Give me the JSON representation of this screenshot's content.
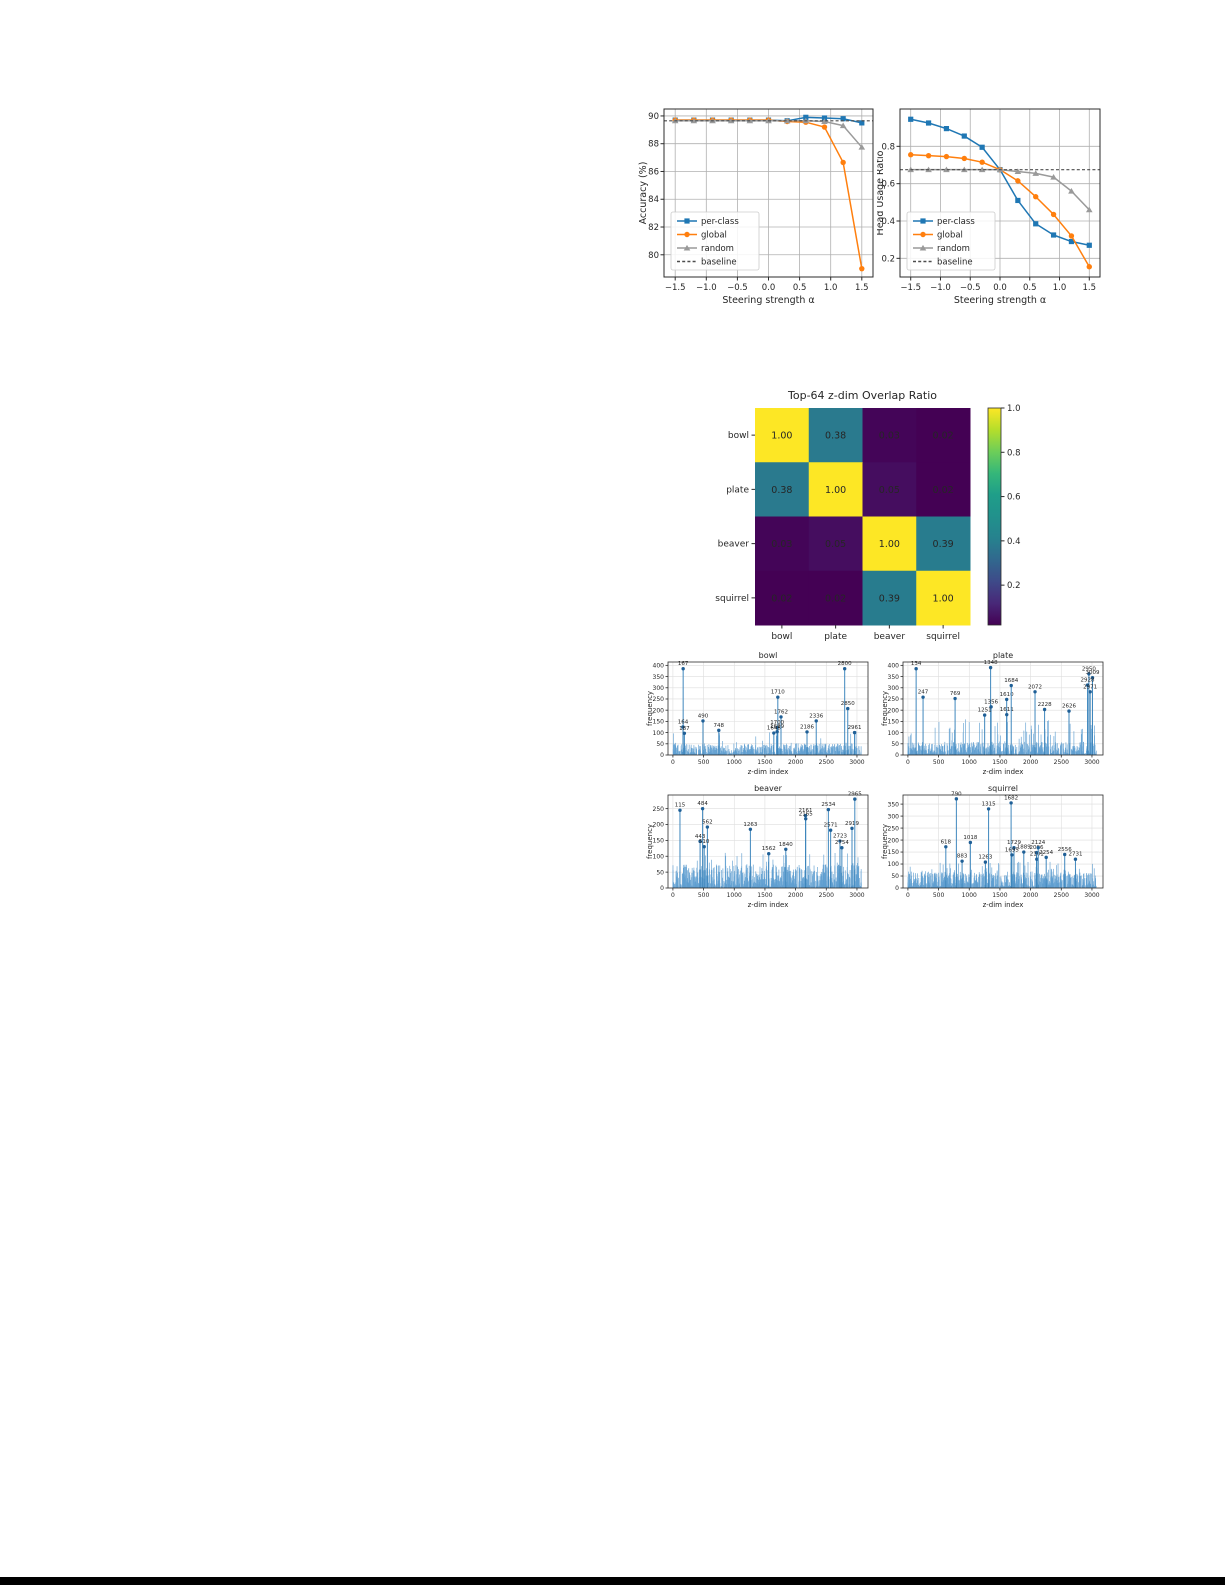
{
  "page": {
    "background": "#ffffff",
    "bottom_border_color": "#000000"
  },
  "colors": {
    "per_class": "#1f77b4",
    "global": "#ff7f0e",
    "random": "#9a9a9a",
    "baseline": "#4d4d4d",
    "spike_bar": "#5f9fd0",
    "spike_stem": "#3f87bd",
    "spike_dot": "#1f5f96",
    "grid": "#b0b0b0",
    "axes_edge": "#2b2b2b"
  },
  "chart_data": [
    {
      "id": "accuracy",
      "type": "line",
      "xlabel": "Steering strength α",
      "ylabel": "Accuracy (%)",
      "x": [
        -1.5,
        -1.2,
        -0.9,
        -0.6,
        -0.3,
        0.0,
        0.3,
        0.6,
        0.9,
        1.2,
        1.5
      ],
      "xticks": [
        -1.5,
        -1.0,
        -0.5,
        0.0,
        0.5,
        1.0,
        1.5
      ],
      "yticks": [
        80,
        82,
        84,
        86,
        88,
        90
      ],
      "xlim": [
        -1.68,
        1.68
      ],
      "ylim": [
        78.4,
        90.5
      ],
      "grid": true,
      "legend_position": "lower-left",
      "series": [
        {
          "name": "per-class",
          "color": "#1f77b4",
          "marker": "square",
          "values": [
            89.7,
            89.7,
            89.7,
            89.7,
            89.7,
            89.7,
            89.65,
            89.9,
            89.85,
            89.8,
            89.5
          ]
        },
        {
          "name": "global",
          "color": "#ff7f0e",
          "marker": "circle",
          "values": [
            89.7,
            89.7,
            89.7,
            89.7,
            89.7,
            89.7,
            89.6,
            89.55,
            89.2,
            86.65,
            79.0
          ]
        },
        {
          "name": "random",
          "color": "#9a9a9a",
          "marker": "triangle",
          "values": [
            89.65,
            89.65,
            89.65,
            89.65,
            89.65,
            89.65,
            89.65,
            89.65,
            89.6,
            89.3,
            87.75
          ]
        },
        {
          "name": "baseline",
          "color": "#4d4d4d",
          "dash": true,
          "constant": 89.65
        }
      ]
    },
    {
      "id": "head_usage",
      "type": "line",
      "xlabel": "Steering strength α",
      "ylabel": "Head Usage Ratio",
      "x": [
        -1.5,
        -1.2,
        -0.9,
        -0.6,
        -0.3,
        0.0,
        0.3,
        0.6,
        0.9,
        1.2,
        1.5
      ],
      "xticks": [
        -1.5,
        -1.0,
        -0.5,
        0.0,
        0.5,
        1.0,
        1.5
      ],
      "yticks": [
        0.2,
        0.4,
        0.6,
        0.8
      ],
      "xlim": [
        -1.68,
        1.68
      ],
      "ylim": [
        0.1,
        1.0
      ],
      "grid": true,
      "legend_position": "lower-left",
      "series": [
        {
          "name": "per-class",
          "color": "#1f77b4",
          "marker": "square",
          "values": [
            0.945,
            0.925,
            0.895,
            0.855,
            0.795,
            0.675,
            0.51,
            0.385,
            0.325,
            0.29,
            0.27
          ]
        },
        {
          "name": "global",
          "color": "#ff7f0e",
          "marker": "circle",
          "values": [
            0.755,
            0.75,
            0.745,
            0.735,
            0.715,
            0.675,
            0.615,
            0.53,
            0.435,
            0.32,
            0.155
          ]
        },
        {
          "name": "random",
          "color": "#9a9a9a",
          "marker": "triangle",
          "values": [
            0.675,
            0.675,
            0.675,
            0.675,
            0.675,
            0.675,
            0.665,
            0.655,
            0.635,
            0.56,
            0.46
          ]
        },
        {
          "name": "baseline",
          "color": "#4d4d4d",
          "dash": true,
          "constant": 0.675
        }
      ]
    },
    {
      "id": "overlap",
      "type": "heatmap",
      "title": "Top-64 z-dim Overlap Ratio",
      "labels": [
        "bowl",
        "plate",
        "beaver",
        "squirrel"
      ],
      "matrix": [
        [
          1.0,
          0.38,
          0.03,
          0.02
        ],
        [
          0.38,
          1.0,
          0.05,
          0.02
        ],
        [
          0.03,
          0.05,
          1.0,
          0.39
        ],
        [
          0.02,
          0.02,
          0.39,
          1.0
        ]
      ],
      "vmin": 0.02,
      "vmax": 1.0,
      "colorbar_ticks": [
        0.2,
        0.4,
        0.6,
        0.8,
        1.0
      ],
      "colormap": "viridis"
    },
    {
      "id": "bowl",
      "type": "bar",
      "title": "bowl",
      "xlabel": "z-dim index",
      "ylabel": "frequency",
      "xlim": [
        -80,
        3180
      ],
      "ylim": [
        0,
        415
      ],
      "xticks": [
        0,
        500,
        1000,
        1500,
        2000,
        2500,
        3000
      ],
      "yticks": [
        0,
        50,
        100,
        150,
        200,
        250,
        300,
        350,
        400
      ],
      "noise": {
        "seed": 101,
        "count": 900,
        "base": 48,
        "tall_prob": 0.03,
        "tall_min": 50,
        "tall_range": 60
      },
      "peaks": [
        {
          "dim": 167,
          "freq": 385
        },
        {
          "dim": 164,
          "freq": 125
        },
        {
          "dim": 187,
          "freq": 97
        },
        {
          "dim": 490,
          "freq": 152
        },
        {
          "dim": 748,
          "freq": 110
        },
        {
          "dim": 1710,
          "freq": 258
        },
        {
          "dim": 1762,
          "freq": 170
        },
        {
          "dim": 1700,
          "freq": 122
        },
        {
          "dim": 1645,
          "freq": 98
        },
        {
          "dim": 1699,
          "freq": 104
        },
        {
          "dim": 2186,
          "freq": 103
        },
        {
          "dim": 2336,
          "freq": 152
        },
        {
          "dim": 2800,
          "freq": 385
        },
        {
          "dim": 2850,
          "freq": 207
        },
        {
          "dim": 2961,
          "freq": 100
        }
      ]
    },
    {
      "id": "plate",
      "type": "bar",
      "title": "plate",
      "xlabel": "z-dim index",
      "ylabel": "frequency",
      "xlim": [
        -80,
        3180
      ],
      "ylim": [
        0,
        415
      ],
      "xticks": [
        0,
        500,
        1000,
        1500,
        2000,
        2500,
        3000
      ],
      "yticks": [
        0,
        50,
        100,
        150,
        200,
        250,
        300,
        350,
        400
      ],
      "noise": {
        "seed": 202,
        "count": 900,
        "base": 55,
        "tall_prob": 0.05,
        "tall_min": 60,
        "tall_range": 100
      },
      "peaks": [
        {
          "dim": 134,
          "freq": 385
        },
        {
          "dim": 247,
          "freq": 258
        },
        {
          "dim": 769,
          "freq": 252
        },
        {
          "dim": 1348,
          "freq": 390
        },
        {
          "dim": 1356,
          "freq": 215
        },
        {
          "dim": 1251,
          "freq": 178
        },
        {
          "dim": 1610,
          "freq": 248
        },
        {
          "dim": 1611,
          "freq": 180
        },
        {
          "dim": 1684,
          "freq": 310
        },
        {
          "dim": 2072,
          "freq": 282
        },
        {
          "dim": 2228,
          "freq": 203
        },
        {
          "dim": 2626,
          "freq": 196
        },
        {
          "dim": 2950,
          "freq": 362
        },
        {
          "dim": 3009,
          "freq": 345
        },
        {
          "dim": 2928,
          "freq": 312
        },
        {
          "dim": 2971,
          "freq": 282
        }
      ]
    },
    {
      "id": "beaver",
      "type": "bar",
      "title": "beaver",
      "xlabel": "z-dim index",
      "ylabel": "frequency",
      "xlim": [
        -80,
        3180
      ],
      "ylim": [
        0,
        293
      ],
      "xticks": [
        0,
        500,
        1000,
        1500,
        2000,
        2500,
        3000
      ],
      "yticks": [
        0,
        50,
        100,
        150,
        200,
        250
      ],
      "noise": {
        "seed": 303,
        "count": 950,
        "base": 70,
        "tall_prob": 0.05,
        "tall_min": 60,
        "tall_range": 55
      },
      "peaks": [
        {
          "dim": 115,
          "freq": 245
        },
        {
          "dim": 484,
          "freq": 250
        },
        {
          "dim": 562,
          "freq": 192
        },
        {
          "dim": 443,
          "freq": 147
        },
        {
          "dim": 510,
          "freq": 130
        },
        {
          "dim": 1263,
          "freq": 185
        },
        {
          "dim": 1562,
          "freq": 108
        },
        {
          "dim": 1840,
          "freq": 122
        },
        {
          "dim": 2161,
          "freq": 228
        },
        {
          "dim": 2165,
          "freq": 218
        },
        {
          "dim": 2534,
          "freq": 247
        },
        {
          "dim": 2571,
          "freq": 182
        },
        {
          "dim": 2723,
          "freq": 148
        },
        {
          "dim": 2754,
          "freq": 127
        },
        {
          "dim": 2919,
          "freq": 188
        },
        {
          "dim": 2965,
          "freq": 280
        }
      ]
    },
    {
      "id": "squirrel",
      "type": "bar",
      "title": "squirrel",
      "xlabel": "z-dim index",
      "ylabel": "frequency",
      "xlim": [
        -80,
        3180
      ],
      "ylim": [
        0,
        388
      ],
      "xticks": [
        0,
        500,
        1000,
        1500,
        2000,
        2500,
        3000
      ],
      "yticks": [
        0,
        50,
        100,
        150,
        200,
        250,
        300,
        350
      ],
      "noise": {
        "seed": 404,
        "count": 950,
        "base": 65,
        "tall_prob": 0.05,
        "tall_min": 55,
        "tall_range": 55
      },
      "peaks": [
        {
          "dim": 618,
          "freq": 172
        },
        {
          "dim": 790,
          "freq": 372
        },
        {
          "dim": 883,
          "freq": 112
        },
        {
          "dim": 1018,
          "freq": 190
        },
        {
          "dim": 1263,
          "freq": 108
        },
        {
          "dim": 1315,
          "freq": 330
        },
        {
          "dim": 1682,
          "freq": 355
        },
        {
          "dim": 1729,
          "freq": 168
        },
        {
          "dim": 1695,
          "freq": 138
        },
        {
          "dim": 1889,
          "freq": 150
        },
        {
          "dim": 2096,
          "freq": 148
        },
        {
          "dim": 2101,
          "freq": 120
        },
        {
          "dim": 2124,
          "freq": 168
        },
        {
          "dim": 2254,
          "freq": 128
        },
        {
          "dim": 2556,
          "freq": 140
        },
        {
          "dim": 2731,
          "freq": 120
        }
      ]
    }
  ]
}
